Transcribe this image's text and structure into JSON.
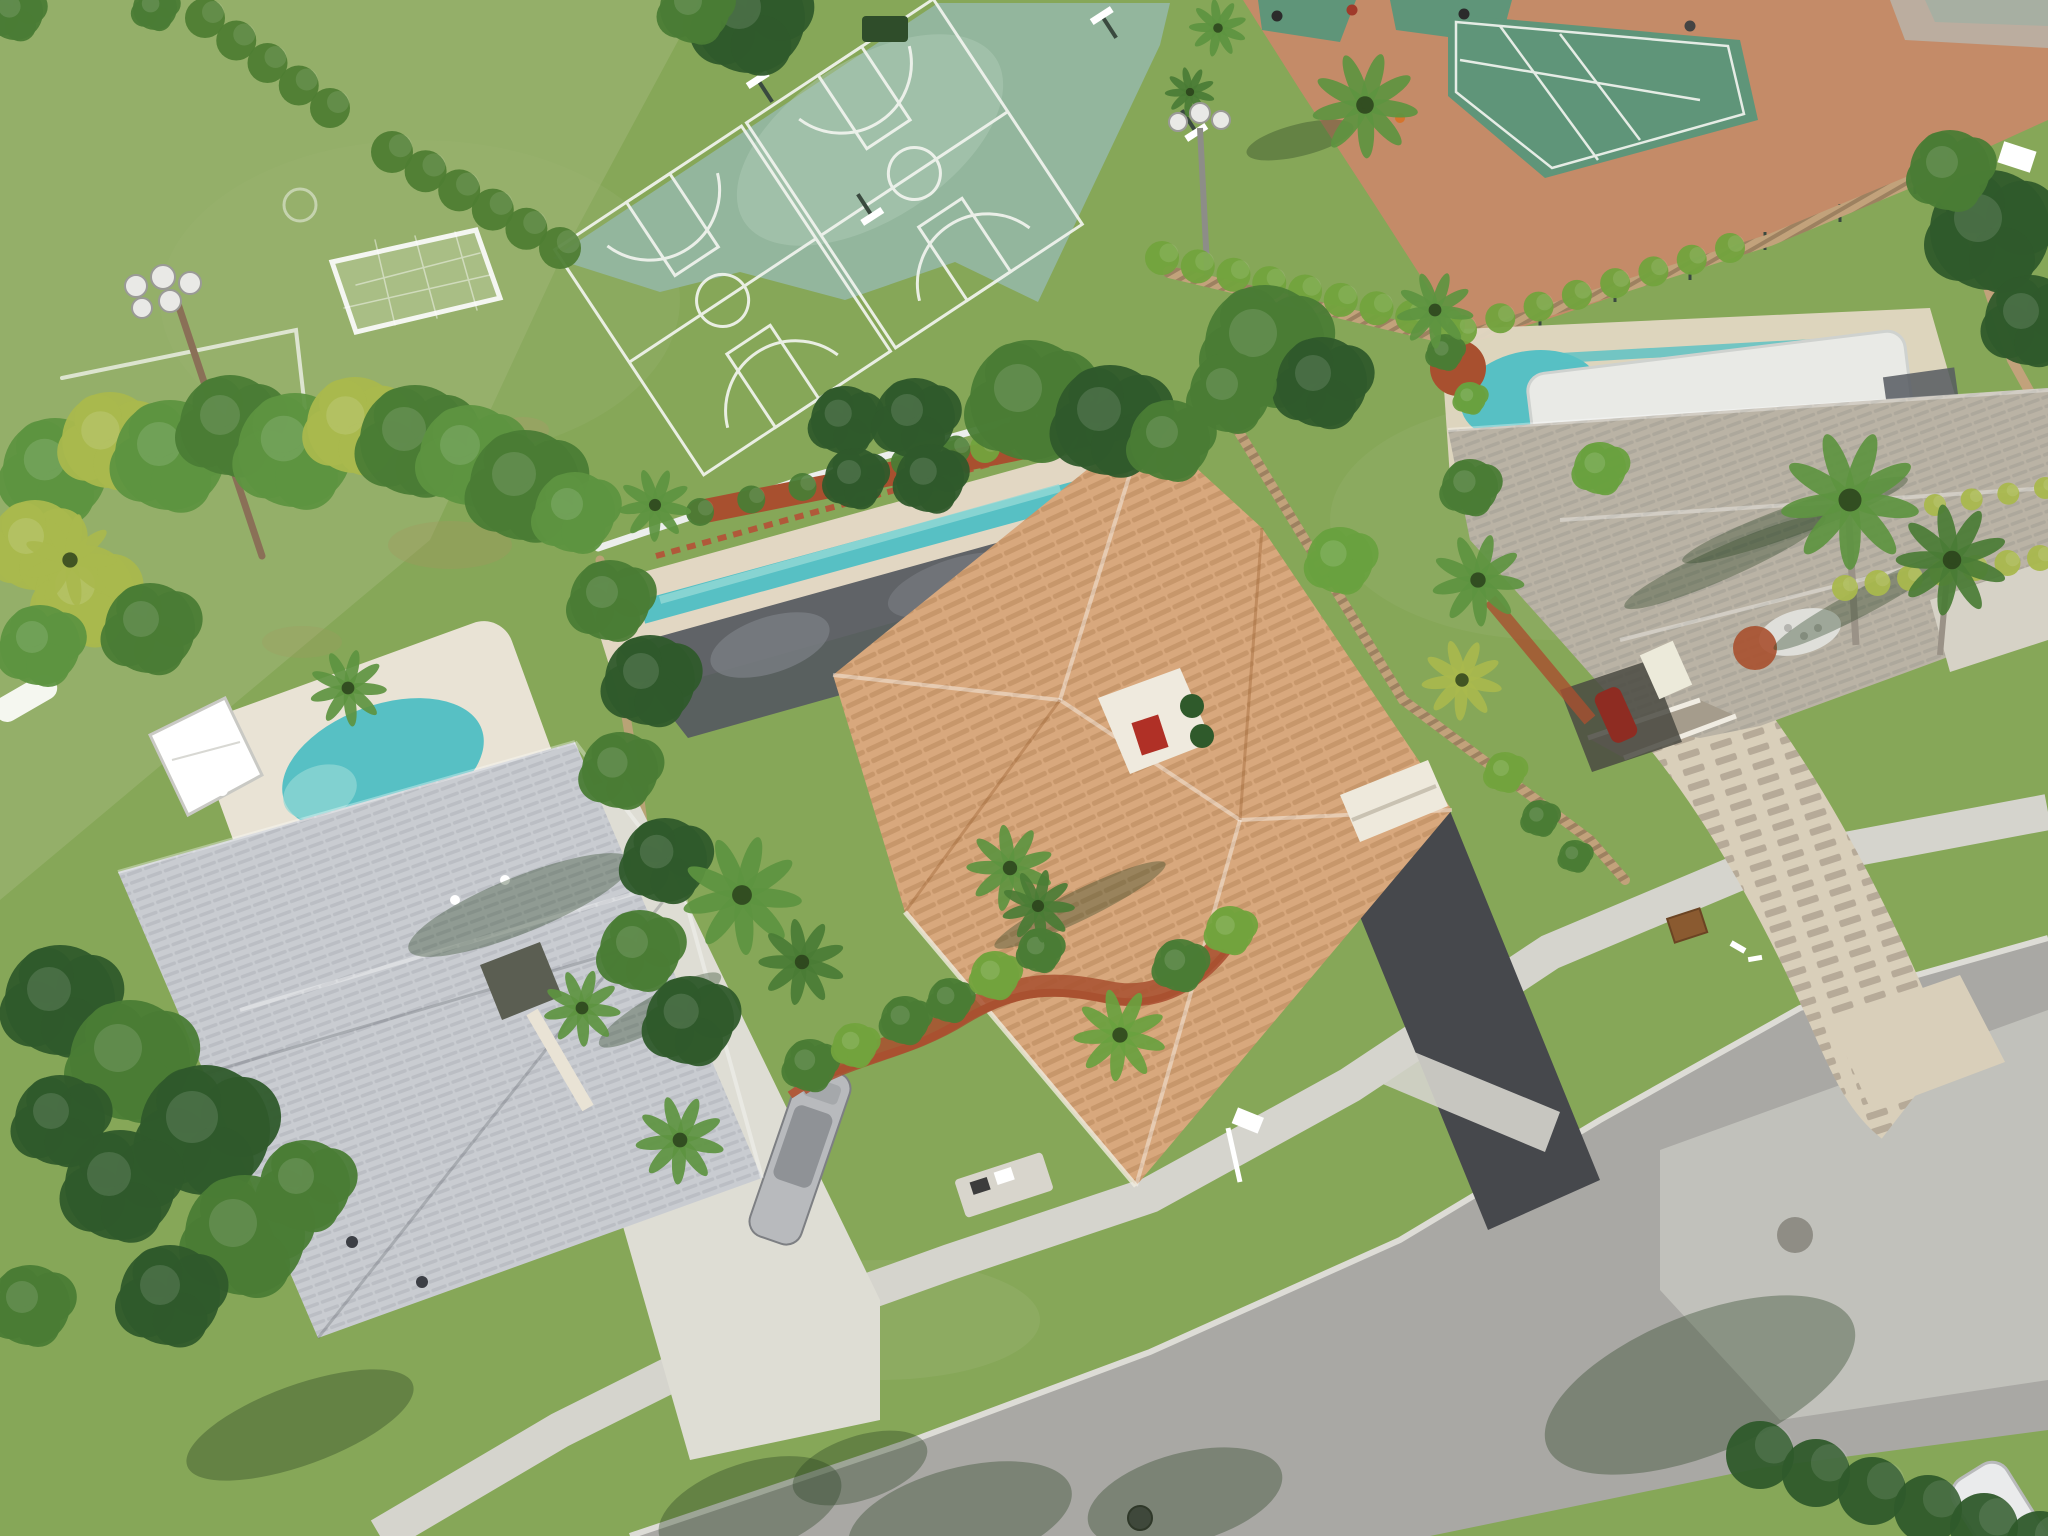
{
  "image": {
    "kind": "aerial-drone-photo",
    "description": "Aerial view of a suburban Florida neighborhood: three single-family homes with pools along a curved street, bordered by a community recreation area with a soccer field, two basketball courts and clay-surround tennis courts",
    "width": 2048,
    "height": 1536
  },
  "palette": {
    "lawn": "#86a758",
    "lawn_light": "#9ab473",
    "lawn_dark": "#6e9150",
    "field": "#96b06c",
    "worn": "#a3985f",
    "court_green": "#93b69d",
    "court_worn": "#b2cbb8",
    "tennis_green": "#5f9579",
    "clay": "#c48b68",
    "line_white": "#f4f6f1",
    "hedge": "#4e7d33",
    "hedge_bright": "#72a33d",
    "tree_dark": "#2f5a2b",
    "tree_mid": "#4a7c35",
    "tree_light": "#69a13f",
    "palm_green": "#5d9440",
    "palm_yellow": "#a9b84d",
    "fence_wood": "#c2a27b",
    "fence_white": "#eceeec",
    "roof_gray": "#c9ccd1",
    "roof_gray_dark": "#aeb2b9",
    "roof_tan": "#d8a87d",
    "roof_tan_dark": "#c08f62",
    "roof_beige": "#bab3a5",
    "roof_beige_dark": "#a59c8c",
    "pool_teal": "#57c0c4",
    "pool_teal_light": "#93d8d6",
    "pool_cover": "#e9eae6",
    "screen_dark": "#565a60",
    "screen_mid": "#7b7f84",
    "deck_white": "#e9e3d5",
    "stone": "#e2d7c3",
    "mulch_red": "#a8502f",
    "brick_edge": "#b0593a",
    "drive_white": "#deddd4",
    "drive_dark": "#46484c",
    "paver": "#d9cfba",
    "paver_dash": "#b4a99c",
    "road": "#a9a8a4",
    "road_light": "#c6c5c0",
    "sidewalk": "#d5d4cd",
    "curb": "#dddcd6",
    "shadow_green": "#24401f",
    "shadow_road": "#565d52",
    "pole": "#8a7057",
    "light_white": "#e9e9e6",
    "car_silver": "#b8babd",
    "car_white": "#eaebec",
    "car_red": "#8e2c22",
    "white": "#ffffff",
    "dark": "#2b2b2b",
    "grate": "#8a5a30"
  },
  "scene_labels": {
    "recreation": [
      "soccer-field",
      "soccer-goal",
      "floodlight-pole",
      "basketball-courts",
      "tennis-courts",
      "clay-path",
      "boundary-hedges"
    ],
    "lots": [
      "left-house-gray-roof-with-pool",
      "center-house-tan-tile-roof-with-screened-pool",
      "right-house-beige-roof-with-covered-pool"
    ],
    "street": [
      "curved-road",
      "sidewalk",
      "concrete-driveway",
      "asphalt-driveway",
      "paver-driveway",
      "manhole",
      "mailboxes"
    ]
  },
  "counts": {
    "houses": 3,
    "pools": 3,
    "basketball_courts": 2,
    "tennis_courts": 4,
    "parked_cars": 3
  },
  "trees": [
    {
      "x": 55,
      "y": 470,
      "r": 52,
      "c": "palm_green"
    },
    {
      "x": 110,
      "y": 440,
      "r": 48,
      "c": "palm_yellow"
    },
    {
      "x": 170,
      "y": 455,
      "r": 55,
      "c": "palm_green"
    },
    {
      "x": 230,
      "y": 425,
      "r": 50,
      "c": "tree_mid"
    },
    {
      "x": 295,
      "y": 450,
      "r": 57,
      "c": "palm_green"
    },
    {
      "x": 355,
      "y": 425,
      "r": 48,
      "c": "palm_yellow"
    },
    {
      "x": 415,
      "y": 440,
      "r": 55,
      "c": "tree_mid"
    },
    {
      "x": 470,
      "y": 455,
      "r": 50,
      "c": "palm_green"
    },
    {
      "x": 525,
      "y": 485,
      "r": 55,
      "c": "tree_mid"
    },
    {
      "x": 575,
      "y": 512,
      "r": 40,
      "c": "palm_green"
    },
    {
      "x": 35,
      "y": 545,
      "r": 45,
      "c": "palm_yellow"
    },
    {
      "x": 85,
      "y": 595,
      "r": 50,
      "c": "palm_yellow"
    },
    {
      "x": 150,
      "y": 628,
      "r": 45,
      "c": "tree_mid"
    },
    {
      "x": 40,
      "y": 645,
      "r": 40,
      "c": "palm_green"
    },
    {
      "x": 60,
      "y": 1000,
      "r": 55,
      "c": "tree_dark"
    },
    {
      "x": 130,
      "y": 1060,
      "r": 60,
      "c": "tree_mid"
    },
    {
      "x": 205,
      "y": 1130,
      "r": 65,
      "c": "tree_dark"
    },
    {
      "x": 120,
      "y": 1185,
      "r": 55,
      "c": "tree_dark"
    },
    {
      "x": 245,
      "y": 1235,
      "r": 60,
      "c": "tree_mid"
    },
    {
      "x": 60,
      "y": 1120,
      "r": 45,
      "c": "tree_dark"
    },
    {
      "x": 170,
      "y": 1295,
      "r": 50,
      "c": "tree_dark"
    },
    {
      "x": 305,
      "y": 1185,
      "r": 45,
      "c": "tree_mid"
    },
    {
      "x": 30,
      "y": 1305,
      "r": 40,
      "c": "tree_mid"
    },
    {
      "x": 610,
      "y": 600,
      "r": 40,
      "c": "tree_mid"
    },
    {
      "x": 650,
      "y": 680,
      "r": 45,
      "c": "tree_dark"
    },
    {
      "x": 620,
      "y": 770,
      "r": 38,
      "c": "tree_mid"
    },
    {
      "x": 665,
      "y": 860,
      "r": 42,
      "c": "tree_dark"
    },
    {
      "x": 640,
      "y": 950,
      "r": 40,
      "c": "tree_mid"
    },
    {
      "x": 690,
      "y": 1020,
      "r": 44,
      "c": "tree_dark"
    },
    {
      "x": 845,
      "y": 420,
      "r": 34,
      "c": "tree_dark"
    },
    {
      "x": 855,
      "y": 478,
      "r": 30,
      "c": "tree_dark"
    },
    {
      "x": 915,
      "y": 418,
      "r": 40,
      "c": "tree_dark"
    },
    {
      "x": 930,
      "y": 478,
      "r": 34,
      "c": "tree_dark"
    },
    {
      "x": 1030,
      "y": 400,
      "r": 60,
      "c": "tree_mid"
    },
    {
      "x": 1110,
      "y": 420,
      "r": 55,
      "c": "tree_dark"
    },
    {
      "x": 1170,
      "y": 440,
      "r": 40,
      "c": "tree_mid"
    },
    {
      "x": 1265,
      "y": 345,
      "r": 60,
      "c": "tree_mid"
    },
    {
      "x": 1322,
      "y": 382,
      "r": 45,
      "c": "tree_dark"
    },
    {
      "x": 1230,
      "y": 392,
      "r": 40,
      "c": "tree_mid"
    },
    {
      "x": 1470,
      "y": 487,
      "r": 28,
      "c": "tree_mid"
    },
    {
      "x": 1600,
      "y": 468,
      "r": 26,
      "c": "tree_light"
    },
    {
      "x": 1340,
      "y": 560,
      "r": 33,
      "c": "tree_light"
    },
    {
      "x": 1990,
      "y": 230,
      "r": 60,
      "c": "tree_dark"
    },
    {
      "x": 2030,
      "y": 320,
      "r": 45,
      "c": "tree_dark"
    },
    {
      "x": 1950,
      "y": 170,
      "r": 40,
      "c": "tree_mid"
    },
    {
      "x": 750,
      "y": 18,
      "r": 55,
      "c": "tree_dark"
    },
    {
      "x": 695,
      "y": 8,
      "r": 35,
      "c": "tree_mid"
    },
    {
      "x": 15,
      "y": 12,
      "r": 28,
      "c": "tree_mid"
    },
    {
      "x": 155,
      "y": 8,
      "r": 22,
      "c": "tree_mid"
    },
    {
      "x": 810,
      "y": 1065,
      "r": 26,
      "c": "tree_mid"
    },
    {
      "x": 855,
      "y": 1045,
      "r": 22,
      "c": "hedge_bright"
    },
    {
      "x": 905,
      "y": 1020,
      "r": 24,
      "c": "tree_mid"
    },
    {
      "x": 950,
      "y": 1000,
      "r": 22,
      "c": "tree_mid"
    },
    {
      "x": 995,
      "y": 975,
      "r": 24,
      "c": "hedge_bright"
    },
    {
      "x": 1040,
      "y": 950,
      "r": 22,
      "c": "tree_mid"
    },
    {
      "x": 1180,
      "y": 965,
      "r": 26,
      "c": "tree_mid"
    },
    {
      "x": 1230,
      "y": 930,
      "r": 24,
      "c": "hedge_bright"
    },
    {
      "x": 1505,
      "y": 772,
      "r": 20,
      "c": "hedge_bright"
    },
    {
      "x": 1540,
      "y": 818,
      "r": 18,
      "c": "tree_mid"
    },
    {
      "x": 1575,
      "y": 856,
      "r": 16,
      "c": "tree_mid"
    },
    {
      "x": 1445,
      "y": 352,
      "r": 18,
      "c": "tree_mid"
    },
    {
      "x": 1470,
      "y": 398,
      "r": 16,
      "c": "tree_light"
    }
  ],
  "palms": [
    {
      "x": 1365,
      "y": 105,
      "r": 55,
      "c": "palm_green"
    },
    {
      "x": 1218,
      "y": 28,
      "r": 30,
      "c": "palm_green"
    },
    {
      "x": 1190,
      "y": 92,
      "r": 26,
      "c": "tree_mid"
    },
    {
      "x": 742,
      "y": 895,
      "r": 62,
      "c": "palm_green"
    },
    {
      "x": 802,
      "y": 962,
      "r": 45,
      "c": "tree_mid"
    },
    {
      "x": 1120,
      "y": 1035,
      "r": 48,
      "c": "tree_light"
    },
    {
      "x": 1010,
      "y": 868,
      "r": 45,
      "c": "palm_green"
    },
    {
      "x": 1038,
      "y": 906,
      "r": 38,
      "c": "tree_mid"
    },
    {
      "x": 655,
      "y": 505,
      "r": 38,
      "c": "palm_green"
    },
    {
      "x": 348,
      "y": 688,
      "r": 40,
      "c": "palm_green"
    },
    {
      "x": 1850,
      "y": 500,
      "r": 72,
      "c": "palm_green"
    },
    {
      "x": 1952,
      "y": 560,
      "r": 58,
      "c": "tree_mid"
    },
    {
      "x": 1478,
      "y": 580,
      "r": 48,
      "c": "palm_green"
    },
    {
      "x": 1462,
      "y": 680,
      "r": 42,
      "c": "palm_yellow"
    },
    {
      "x": 1435,
      "y": 310,
      "r": 40,
      "c": "palm_green"
    },
    {
      "x": 70,
      "y": 560,
      "r": 48,
      "c": "palm_yellow"
    },
    {
      "x": 582,
      "y": 1008,
      "r": 40,
      "c": "palm_green"
    },
    {
      "x": 680,
      "y": 1140,
      "r": 46,
      "c": "palm_green"
    }
  ],
  "hedge_rows": [
    {
      "x1": 205,
      "y1": 18,
      "x2": 330,
      "y2": 108,
      "r": 20,
      "n": 5,
      "c": "hedge"
    },
    {
      "x1": 392,
      "y1": 152,
      "x2": 560,
      "y2": 248,
      "r": 21,
      "n": 6,
      "c": "hedge"
    },
    {
      "x1": 1162,
      "y1": 258,
      "x2": 1448,
      "y2": 325,
      "r": 17,
      "n": 9,
      "c": "hedge_bright"
    },
    {
      "x1": 1462,
      "y1": 330,
      "x2": 1730,
      "y2": 248,
      "r": 15,
      "n": 8,
      "c": "hedge_bright"
    },
    {
      "x1": 985,
      "y1": 448,
      "x2": 1140,
      "y2": 428,
      "r": 15,
      "n": 5,
      "c": "hedge_bright"
    },
    {
      "x1": 1760,
      "y1": 1455,
      "x2": 2040,
      "y2": 1545,
      "r": 34,
      "n": 6,
      "c": "tree_dark"
    },
    {
      "x1": 1845,
      "y1": 588,
      "x2": 2040,
      "y2": 558,
      "r": 13,
      "n": 7,
      "c": "palm_yellow"
    },
    {
      "x1": 1935,
      "y1": 505,
      "x2": 2045,
      "y2": 488,
      "r": 11,
      "n": 4,
      "c": "palm_yellow"
    },
    {
      "x1": 700,
      "y1": 512,
      "x2": 1110,
      "y2": 412,
      "r": 14,
      "n": 9,
      "c": "tree_mid"
    }
  ],
  "shadows": [
    {
      "x": 750,
      "y": 1508,
      "rx": 95,
      "ry": 45,
      "a": -18
    },
    {
      "x": 960,
      "y": 1518,
      "rx": 115,
      "ry": 50,
      "a": -15
    },
    {
      "x": 1185,
      "y": 1498,
      "rx": 100,
      "ry": 45,
      "a": -15
    },
    {
      "x": 860,
      "y": 1468,
      "rx": 70,
      "ry": 32,
      "a": -18
    },
    {
      "x": 1700,
      "y": 1385,
      "rx": 165,
      "ry": 70,
      "a": -22
    },
    {
      "x": 1300,
      "y": 140,
      "rx": 55,
      "ry": 16,
      "a": -14
    },
    {
      "x": 1080,
      "y": 905,
      "rx": 95,
      "ry": 15,
      "a": -26
    },
    {
      "x": 660,
      "y": 1010,
      "rx": 70,
      "ry": 16,
      "a": -30
    },
    {
      "x": 1725,
      "y": 562,
      "rx": 110,
      "ry": 16,
      "a": -24
    },
    {
      "x": 1795,
      "y": 520,
      "rx": 120,
      "ry": 15,
      "a": -20
    },
    {
      "x": 1862,
      "y": 602,
      "rx": 100,
      "ry": 13,
      "a": -28
    },
    {
      "x": 300,
      "y": 1425,
      "rx": 120,
      "ry": 40,
      "a": -20
    },
    {
      "x": 520,
      "y": 905,
      "rx": 120,
      "ry": 28,
      "a": -22
    }
  ],
  "people": [
    {
      "x": 1277,
      "y": 16,
      "c": "#2b2b2b"
    },
    {
      "x": 1352,
      "y": 10,
      "c": "#a03a2a"
    },
    {
      "x": 1464,
      "y": 14,
      "c": "#2b2b2b"
    },
    {
      "x": 1690,
      "y": 26,
      "c": "#444444"
    }
  ],
  "field_lights": [
    {
      "x": 136,
      "y": 286,
      "r": 11
    },
    {
      "x": 163,
      "y": 277,
      "r": 12
    },
    {
      "x": 190,
      "y": 283,
      "r": 11
    },
    {
      "x": 142,
      "y": 308,
      "r": 10
    },
    {
      "x": 170,
      "y": 301,
      "r": 11
    }
  ],
  "court_lights": [
    {
      "x": 1178,
      "y": 122,
      "r": 9
    },
    {
      "x": 1200,
      "y": 113,
      "r": 10
    },
    {
      "x": 1221,
      "y": 120,
      "r": 9
    }
  ]
}
